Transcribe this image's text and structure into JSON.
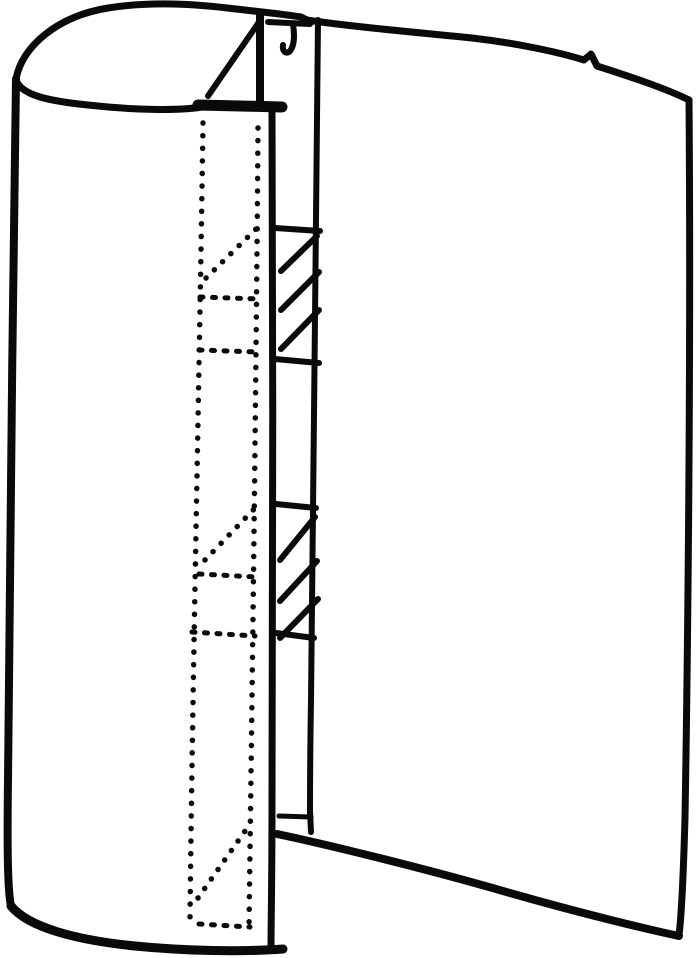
{
  "figure": {
    "description": "Black ink patent-style line drawing of an open cylindrical shell (vertical slit at front) containing a vertical channel mast; two hatched cross-section blocks inside the channel and a hidden internal lattice drawn with dotted lines",
    "background_color": "#ffffff",
    "ink_color": "#0a0a0a",
    "viewbox": "0 0 700 958",
    "canvas": {
      "width": 700,
      "height": 958
    },
    "paths": {
      "back_rim": {
        "d": "M 16 79 C 22 46 58 16 108 8 C 152 1 196 4 236 9 C 262 12 283 14 301 17 L 307 20 C 352 27 424 33 472 38 C 516 43 558 52 584 60 L 591 54 L 597 66 C 628 76 665 88 689 100",
        "w": 7
      },
      "right_edge": {
        "d": "M 689 100 C 691 340 688 640 685 818 C 683 888 681 920 679 935",
        "w": 7
      },
      "left_edge": {
        "d": "M 16 79 C 13 300 9 600 8 780 C 7 858 8 892 11 906",
        "w": 8
      },
      "bottom_left_arc": {
        "d": "M 11 906 C 28 927 75 940 135 946 C 185 951 242 952 283 949",
        "w": 9
      },
      "front_rim_arc": {
        "d": "M 16 80 C 21 95 48 101 88 105 C 132 110 178 111 202 107",
        "w": 7
      },
      "ledge": {
        "d": "M 198 105 L 282 107",
        "w": 11
      },
      "gusset_hypotenuse": {
        "d": "M 259 22 L 208 96",
        "w": 6
      },
      "mast_front_edge": {
        "d": "M 260 15 L 260 101",
        "w": 8
      },
      "rim_stub": {
        "d": "M 268 22 L 310 24",
        "w": 6
      },
      "hook": {
        "d": "M 293 24 C 295 38 294 46 290 51 C 286 55 282 51 283 45",
        "w": 6
      },
      "channel_right_edge": {
        "d": "M 318 20 C 316 220 313 520 311 700 C 310 760 310 796 310 813",
        "w": 6
      },
      "channel_right_foot": {
        "d": "M 310 811 L 311 832",
        "w": 6
      },
      "channel_floor": {
        "d": "M 279 816 L 311 817",
        "w": 5
      },
      "bottom_right_rim": {
        "d": "M 277 834 C 320 843 420 867 510 893 C 580 913 646 929 679 936",
        "w": 8
      },
      "channel_left_edge": {
        "d": "M 272 110 C 273 320 273 620 272 800 C 272 880 271 928 271 947",
        "w": 7
      },
      "rung_1": {
        "d": "M 275 228 L 320 231",
        "w": 6
      },
      "rung_2": {
        "d": "M 275 359 L 319 363",
        "w": 6
      },
      "rung_3": {
        "d": "M 276 504 L 316 508",
        "w": 6
      },
      "rung_4": {
        "d": "M 276 633 L 314 638",
        "w": 6
      },
      "hatch_1a": {
        "d": "M 281 271 L 317 236",
        "w": 6
      },
      "hatch_1b": {
        "d": "M 281 310 L 319 272",
        "w": 6
      },
      "hatch_1c": {
        "d": "M 281 349 L 319 310",
        "w": 6
      },
      "hatch_2a": {
        "d": "M 280 560 L 315 517",
        "w": 6
      },
      "hatch_2b": {
        "d": "M 280 601 L 317 561",
        "w": 6
      },
      "hatch_2c": {
        "d": "M 280 638 L 318 599",
        "w": 6
      },
      "hidden_left_chord": {
        "d": "M 203 123 C 199 400 193 650 190 918",
        "w": 5.5
      },
      "hidden_right_chord": {
        "d": "M 258 128 C 256 400 252 700 249 928",
        "w": 5.5
      },
      "hidden_diag_1": {
        "d": "M 206 278 L 256 229",
        "w": 5.5
      },
      "hidden_diag_2": {
        "d": "M 205 560 L 256 507",
        "w": 5.5
      },
      "hidden_diag_3": {
        "d": "M 198 898 L 250 824",
        "w": 5.5
      },
      "hidden_rung_1": {
        "d": "M 200 297 L 260 299",
        "w": 5
      },
      "hidden_rung_2": {
        "d": "M 199 350 L 258 352",
        "w": 5
      },
      "hidden_rung_3": {
        "d": "M 199 574 L 257 577",
        "w": 5
      },
      "hidden_rung_4": {
        "d": "M 192 632 L 255 636",
        "w": 5
      },
      "hidden_rung_5": {
        "d": "M 199 924 L 250 927",
        "w": 5
      }
    }
  }
}
